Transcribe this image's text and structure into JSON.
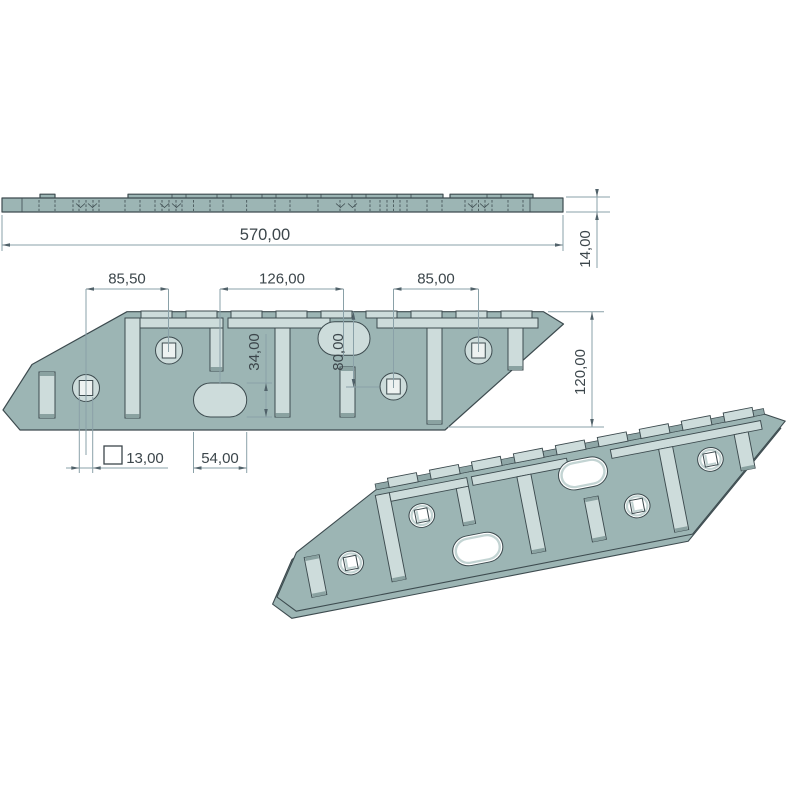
{
  "drawing": {
    "dimensions": {
      "overall_length": "570,00",
      "thickness": "14,00",
      "hole_spacing_left": "85,50",
      "obround_spacing": "126,00",
      "hole_spacing_right": "85,00",
      "obround_height": "34,00",
      "hole_offset_vertical": "80,00",
      "plate_width": "120,00",
      "square_hole_size": "13,00",
      "obround_length": "54,00"
    },
    "colors": {
      "plate": "#9cb5b4",
      "recess": "#cddcdb",
      "outline": "#3d4b4f",
      "dim": "#8aa1a8",
      "arrow": "#51626a",
      "text": "#3c464b",
      "hole": "#ffffff",
      "square": "#edf2f1",
      "cap": "#8aa2a1",
      "band": "#8fa7a7",
      "inner": "#c3d4d3"
    }
  }
}
